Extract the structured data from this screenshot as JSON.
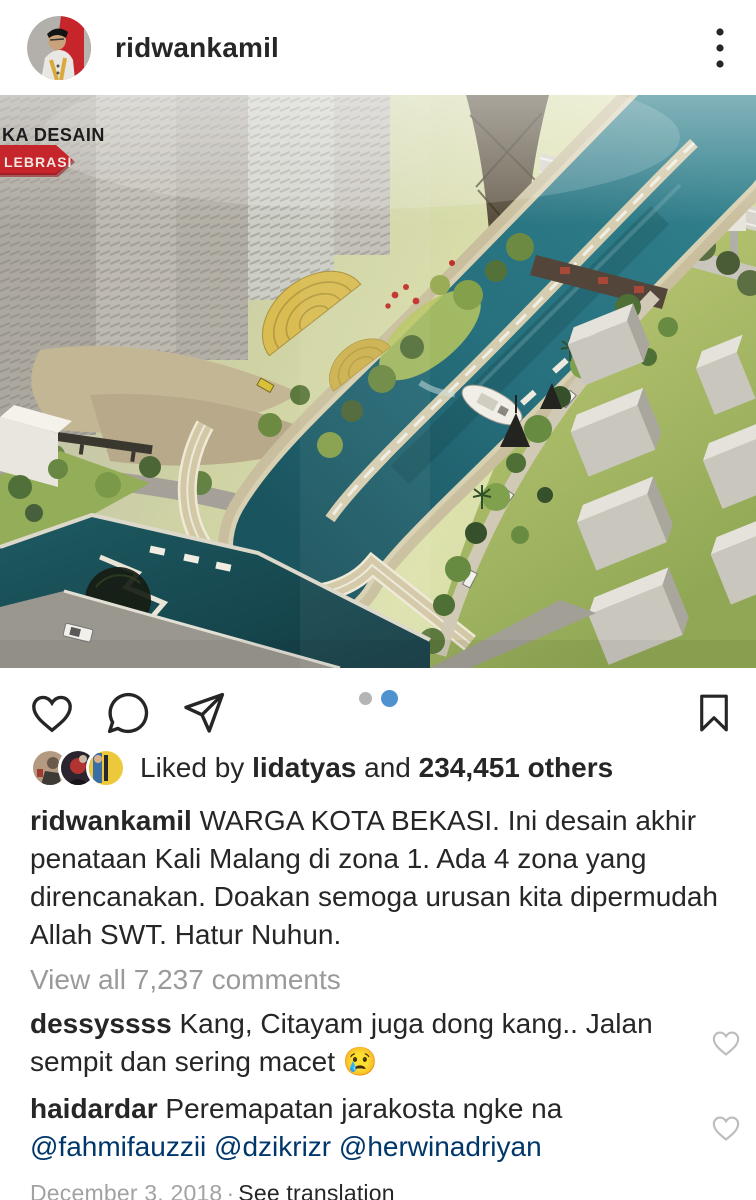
{
  "header": {
    "username": "ridwankamil"
  },
  "photo": {
    "label_title": "KA DESAIN",
    "label_ribbon": "LEBRASI"
  },
  "likes": {
    "liked_by": "Liked by",
    "liker": "lidatyas",
    "and": "and",
    "others": "234,451 others"
  },
  "caption": {
    "username": "ridwankamil",
    "text": "WARGA KOTA BEKASI. Ini desain akhir penataan Kali Malang di zona 1. Ada 4 zona yang direncanakan. Doakan semoga urusan kita dipermudah Allah SWT. Hatur Nuhun."
  },
  "comments": {
    "view_all": "View all 7,237 comments",
    "first": {
      "username": "dessyssss",
      "text": "Kang, Citayam juga dong kang.. Jalan sempit dan sering macet 😢"
    },
    "second": {
      "username": "haidardar",
      "text": "Peremapatan jarakosta ngke na",
      "mentions": "@fahmifauzzii @dzikrizr @herwinadriyan"
    }
  },
  "footer": {
    "date": "December 3, 2018",
    "separator": "·",
    "see_translation": "See translation"
  },
  "colors": {
    "text": "#262626",
    "muted": "#9a9a9a",
    "mention_blue": "#00376b",
    "carousel_blue": "#4f93ce",
    "ribbon_red": "#c5252b"
  }
}
